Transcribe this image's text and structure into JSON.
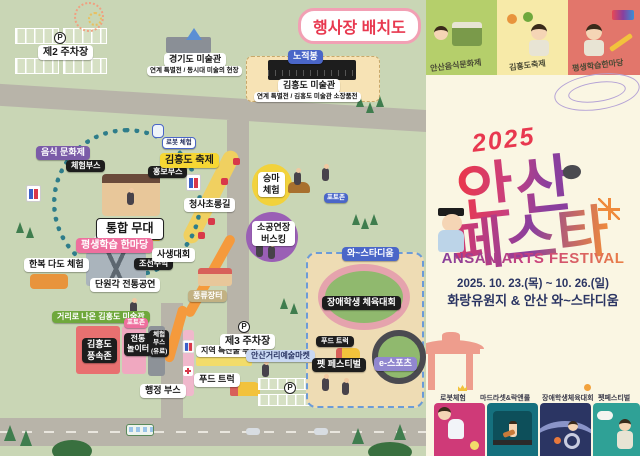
{
  "map": {
    "title": "행사장 배치도",
    "p_label": "P",
    "parking2_label": "제2 주차장",
    "gyeonggi_museum_label": "경기도 미술관",
    "gyeonggi_museum_sub": "연계 특별전 / 동시대 미술의 현장",
    "nojeokbong_label": "노적봉",
    "kimhongdo_museum_label": "김홍도 미술관",
    "kimhongdo_museum_sub": "연계 특별전 / 김홍도 미술관 소장품전",
    "food_culture_label": "음식 문화제",
    "experience_booth_label": "체험부스",
    "main_stage_label": "통합 무대",
    "promo_booth_label": "홍보부스",
    "joseon_tavern_label": "조선주막",
    "robot_experience_label": "로봇 체험",
    "kimhongdo_festival_label": "김홍도 축제",
    "lantern_road_label": "청사초롱길",
    "horse_riding_label": "승마\n체험",
    "photozone_horse_label": "포토존",
    "lifelong_learning_label": "평생학습 한마당",
    "sketch_contest_label": "사생대회",
    "hanbok_tea_label": "한복 다도 체험",
    "danwongak_label": "단원각 전통공연",
    "busking_label": "소공연장\n버스킹",
    "pungnyu_market_label": "풍류장터",
    "street_museum_label": "거리로 나온 김홍도 미술관",
    "photozone_street_label": "포토존",
    "folk_zone_label": "김홍도\n풍속존",
    "trad_playground_label": "전통\n놀이터",
    "exp_booth_paid_label": "체험\n부스\n(유료)",
    "admin_booth_label": "행정 부스",
    "local_products_label": "지역 특산물 부스",
    "parking3_label": "제3 주차장",
    "street_art_market_label": "안산거리예술마켓",
    "food_truck_label": "푸드 트럭",
    "stadium_label": "와~스타디움",
    "disabled_sports_label": "장애학생 체육대회",
    "stadium_food_truck_label": "푸드 트럭",
    "pet_festival_label": "펫 페스티벌",
    "esports_label": "e-스포츠"
  },
  "poster": {
    "top_cards": [
      {
        "label": "안산음식문화제"
      },
      {
        "label": "김홍도축제"
      },
      {
        "label": "평생학습한마당"
      }
    ],
    "year": "2025",
    "title_line1": "안산",
    "title_line2": "페스타",
    "subtitle": "ANSAN ARTS FESTIVAL",
    "dates": "2025. 10. 23.(목) ~ 10. 26.(일)",
    "venue": "화랑유원지 & 안산 와~스타디움",
    "programs": [
      {
        "label": "로봇체험"
      },
      {
        "label": "마드라셋&락앤롤"
      },
      {
        "label": "장애학생체육대회"
      },
      {
        "label": "펫페스티벌"
      }
    ]
  },
  "colors": {
    "map_bg": "#c9d6b5",
    "road": "#b8b4a9",
    "title_red": "#e8384f",
    "poster_bg": "#faf6e3",
    "navy": "#2b3563",
    "path_orange": "#f59a3c",
    "lantern_path_yellow": "#f0d060",
    "stadium_zone": "#eedcb4"
  }
}
